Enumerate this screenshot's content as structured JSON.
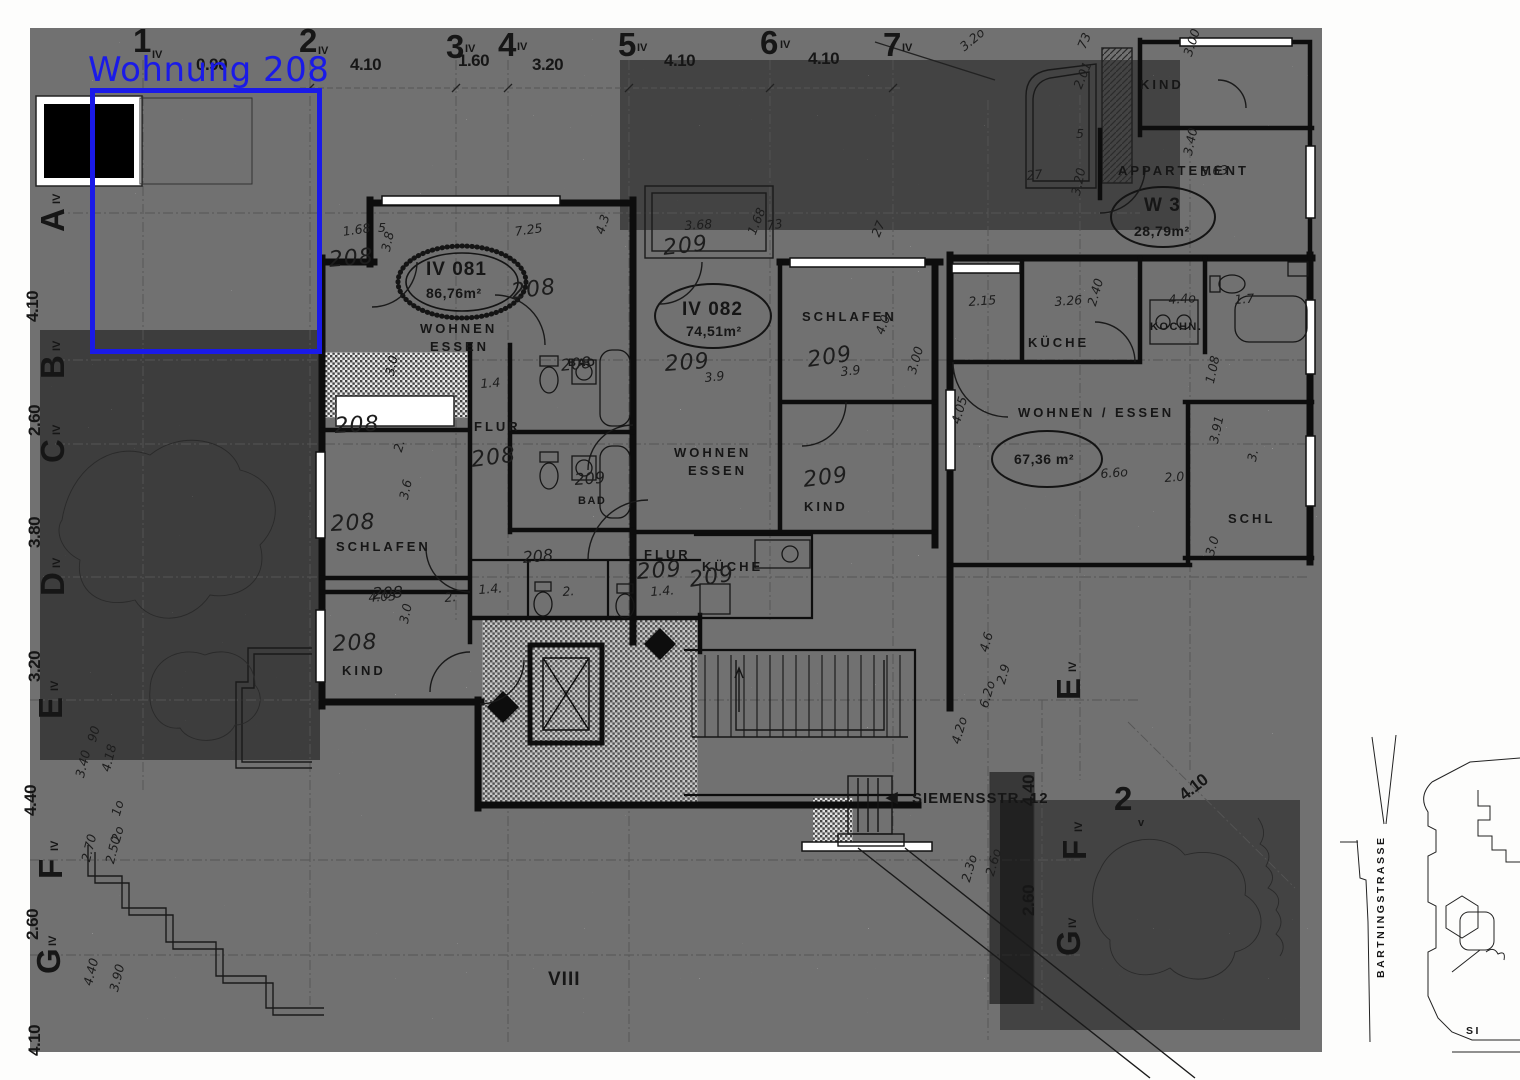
{
  "annotation": {
    "label": "Wohnung 208",
    "color": "#1a1ae8"
  },
  "labels": [
    {
      "t": "1",
      "x": 133,
      "y": 24,
      "c": "gnum",
      "n": "grid-col-1"
    },
    {
      "t": "IV",
      "x": 152,
      "y": 50,
      "c": "gsub"
    },
    {
      "t": "2",
      "x": 299,
      "y": 24,
      "c": "gnum",
      "n": "grid-col-2"
    },
    {
      "t": "IV",
      "x": 318,
      "y": 46,
      "c": "gsub"
    },
    {
      "t": "3",
      "x": 446,
      "y": 30,
      "c": "gnum",
      "n": "grid-col-3"
    },
    {
      "t": "IV",
      "x": 465,
      "y": 44,
      "c": "gsub"
    },
    {
      "t": "4",
      "x": 498,
      "y": 28,
      "c": "gnum",
      "n": "grid-col-4"
    },
    {
      "t": "IV",
      "x": 517,
      "y": 42,
      "c": "gsub"
    },
    {
      "t": "5",
      "x": 618,
      "y": 28,
      "c": "gnum",
      "n": "grid-col-5"
    },
    {
      "t": "IV",
      "x": 637,
      "y": 43,
      "c": "gsub"
    },
    {
      "t": "6",
      "x": 760,
      "y": 26,
      "c": "gnum",
      "n": "grid-col-6"
    },
    {
      "t": "IV",
      "x": 780,
      "y": 40,
      "c": "gsub"
    },
    {
      "t": "7",
      "x": 883,
      "y": 28,
      "c": "gnum",
      "n": "grid-col-7"
    },
    {
      "t": "IV",
      "x": 902,
      "y": 43,
      "c": "gsub"
    },
    {
      "t": "A",
      "x": 36,
      "y": 232,
      "c": "gnum",
      "r": -90,
      "n": "grid-row-a"
    },
    {
      "t": "IV",
      "x": 52,
      "y": 204,
      "c": "gsub",
      "r": -90
    },
    {
      "t": "B",
      "x": 36,
      "y": 379,
      "c": "gnum",
      "r": -90,
      "n": "grid-row-b"
    },
    {
      "t": "IV",
      "x": 52,
      "y": 351,
      "c": "gsub",
      "r": -90
    },
    {
      "t": "C",
      "x": 36,
      "y": 463,
      "c": "gnum",
      "r": -90,
      "n": "grid-row-c"
    },
    {
      "t": "IV",
      "x": 52,
      "y": 435,
      "c": "gsub",
      "r": -90
    },
    {
      "t": "D",
      "x": 36,
      "y": 596,
      "c": "gnum",
      "r": -90,
      "n": "grid-row-d"
    },
    {
      "t": "IV",
      "x": 52,
      "y": 568,
      "c": "gsub",
      "r": -90
    },
    {
      "t": "E",
      "x": 34,
      "y": 719,
      "c": "gnum",
      "r": -90,
      "n": "grid-row-e"
    },
    {
      "t": "IV",
      "x": 50,
      "y": 691,
      "c": "gsub",
      "r": -90
    },
    {
      "t": "F",
      "x": 34,
      "y": 879,
      "c": "gnum",
      "r": -90,
      "n": "grid-row-f"
    },
    {
      "t": "IV",
      "x": 50,
      "y": 851,
      "c": "gsub",
      "r": -90
    },
    {
      "t": "G",
      "x": 32,
      "y": 974,
      "c": "gnum",
      "r": -90,
      "n": "grid-row-g"
    },
    {
      "t": "IV",
      "x": 48,
      "y": 946,
      "c": "gsub",
      "r": -90
    },
    {
      "t": "E",
      "x": 1052,
      "y": 700,
      "c": "gnum",
      "r": -90,
      "n": "grid-row-e-right"
    },
    {
      "t": "IV",
      "x": 1068,
      "y": 672,
      "c": "gsub",
      "r": -90
    },
    {
      "t": "F",
      "x": 1058,
      "y": 860,
      "c": "gnum",
      "r": -90,
      "n": "grid-row-f-right"
    },
    {
      "t": "IV",
      "x": 1074,
      "y": 832,
      "c": "gsub",
      "r": -90
    },
    {
      "t": "G",
      "x": 1052,
      "y": 956,
      "c": "gnum",
      "r": -90,
      "n": "grid-row-g-right"
    },
    {
      "t": "IV",
      "x": 1068,
      "y": 928,
      "c": "gsub",
      "r": -90
    },
    {
      "t": "2",
      "x": 1114,
      "y": 782,
      "c": "gnum",
      "n": "grid-col-2v"
    },
    {
      "t": "v",
      "x": 1138,
      "y": 818,
      "c": "gsub"
    },
    {
      "t": "0.90",
      "x": 196,
      "y": 56,
      "c": "dim"
    },
    {
      "t": "4.10",
      "x": 350,
      "y": 56,
      "c": "dim"
    },
    {
      "t": "1.60",
      "x": 458,
      "y": 52,
      "c": "dim"
    },
    {
      "t": "3.20",
      "x": 532,
      "y": 56,
      "c": "dim"
    },
    {
      "t": "4.10",
      "x": 664,
      "y": 52,
      "c": "dim"
    },
    {
      "t": "4.10",
      "x": 808,
      "y": 50,
      "c": "dim"
    },
    {
      "t": "4.10",
      "x": 24,
      "y": 322,
      "c": "dim",
      "r": -90
    },
    {
      "t": "2.60",
      "x": 26,
      "y": 436,
      "c": "dim",
      "r": -90
    },
    {
      "t": "3.80",
      "x": 26,
      "y": 548,
      "c": "dim",
      "r": -90
    },
    {
      "t": "3.20",
      "x": 26,
      "y": 682,
      "c": "dim",
      "r": -90
    },
    {
      "t": "4.40",
      "x": 22,
      "y": 816,
      "c": "dim",
      "r": -90
    },
    {
      "t": "2.60",
      "x": 24,
      "y": 940,
      "c": "dim",
      "r": -90
    },
    {
      "t": "4.10",
      "x": 26,
      "y": 1056,
      "c": "dim",
      "r": -90
    },
    {
      "t": "4.40",
      "x": 1020,
      "y": 806,
      "c": "dim",
      "r": -90
    },
    {
      "t": "2.60",
      "x": 1020,
      "y": 916,
      "c": "dim",
      "r": -90
    },
    {
      "t": "4.10",
      "x": 1176,
      "y": 790,
      "c": "dim",
      "r": -38
    },
    {
      "t": "KIND",
      "x": 1140,
      "y": 78,
      "c": "room",
      "n": "room-label-kind-top"
    },
    {
      "t": "APPARTEMENT",
      "x": 1118,
      "y": 164,
      "c": "room",
      "n": "room-label-appartement"
    },
    {
      "t": "W 3",
      "x": 1144,
      "y": 196,
      "c": "rmlg",
      "n": "apartment-id-w3"
    },
    {
      "t": "28,79m²",
      "x": 1134,
      "y": 224,
      "c": "area",
      "n": "apartment-area-w3"
    },
    {
      "t": "IV 081",
      "x": 426,
      "y": 260,
      "c": "rmlg",
      "n": "apartment-id-iv081"
    },
    {
      "t": "86,76m²",
      "x": 426,
      "y": 286,
      "c": "area",
      "n": "apartment-area-iv081"
    },
    {
      "t": "WOHNEN",
      "x": 420,
      "y": 322,
      "c": "room",
      "n": "room-label-wohnen-081"
    },
    {
      "t": "ESSEN",
      "x": 430,
      "y": 340,
      "c": "room"
    },
    {
      "t": "IV 082",
      "x": 682,
      "y": 300,
      "c": "rmlg",
      "n": "apartment-id-iv082"
    },
    {
      "t": "74,51m²",
      "x": 686,
      "y": 324,
      "c": "area",
      "n": "apartment-area-iv082"
    },
    {
      "t": "SCHLAFEN",
      "x": 802,
      "y": 310,
      "c": "room",
      "n": "room-label-schlafen-082"
    },
    {
      "t": "KÜCHE",
      "x": 1028,
      "y": 336,
      "c": "room",
      "n": "room-label-kueche-right"
    },
    {
      "t": "KOCHN.",
      "x": 1150,
      "y": 322,
      "c": "roomsm",
      "n": "room-label-kochnische"
    },
    {
      "t": "WOHNEN / ESSEN",
      "x": 1018,
      "y": 406,
      "c": "room",
      "n": "room-label-wohnen-essen-right"
    },
    {
      "t": "67,36 m²",
      "x": 1014,
      "y": 452,
      "c": "area",
      "n": "apartment-area-right"
    },
    {
      "t": "BAD",
      "x": 568,
      "y": 358,
      "c": "roomsm",
      "n": "room-label-bad-upper"
    },
    {
      "t": "FLUR",
      "x": 474,
      "y": 420,
      "c": "room",
      "n": "room-label-flur-081"
    },
    {
      "t": "BAD",
      "x": 578,
      "y": 496,
      "c": "roomsm",
      "n": "room-label-bad-lower"
    },
    {
      "t": "WOHNEN",
      "x": 674,
      "y": 446,
      "c": "room",
      "n": "room-label-wohnen-082"
    },
    {
      "t": "ESSEN",
      "x": 688,
      "y": 464,
      "c": "room"
    },
    {
      "t": "KIND",
      "x": 804,
      "y": 500,
      "c": "room",
      "n": "room-label-kind-082"
    },
    {
      "t": "SCHLAFEN",
      "x": 336,
      "y": 540,
      "c": "room",
      "n": "room-label-schlafen-081"
    },
    {
      "t": "KIND",
      "x": 342,
      "y": 664,
      "c": "room",
      "n": "room-label-kind-081"
    },
    {
      "t": "FLUR",
      "x": 644,
      "y": 548,
      "c": "room",
      "n": "room-label-flur-082"
    },
    {
      "t": "KÜCHE",
      "x": 702,
      "y": 560,
      "c": "room",
      "n": "room-label-kueche-082"
    },
    {
      "t": "SCHL",
      "x": 1228,
      "y": 512,
      "c": "room",
      "n": "room-label-schl-cut"
    },
    {
      "t": "VIII",
      "x": 548,
      "y": 970,
      "c": "rmlg",
      "n": "floor-roman-numeral"
    },
    {
      "t": "◀",
      "x": 886,
      "y": 790,
      "c": "street",
      "n": "direction-arrow-icon"
    },
    {
      "t": "SIEMENSSTR. 12",
      "x": 912,
      "y": 791,
      "c": "street",
      "n": "street-label-siemensstrasse"
    },
    {
      "t": "BARTNINGSTRASSE",
      "x": 1376,
      "y": 978,
      "c": "streetsm",
      "r": -90,
      "n": "street-label-bartningstrasse"
    },
    {
      "t": "SI",
      "x": 1466,
      "y": 1026,
      "c": "streetsm",
      "n": "street-label-si"
    },
    {
      "t": "208",
      "x": 328,
      "y": 250,
      "c": "handlg",
      "r": -5
    },
    {
      "t": "208",
      "x": 510,
      "y": 282,
      "c": "handlg",
      "r": -7
    },
    {
      "t": "208",
      "x": 334,
      "y": 416,
      "c": "handlg",
      "r": -3
    },
    {
      "t": "208",
      "x": 470,
      "y": 450,
      "c": "handlg",
      "r": -7
    },
    {
      "t": "208",
      "x": 330,
      "y": 514,
      "c": "handlg",
      "r": -3
    },
    {
      "t": "208",
      "x": 332,
      "y": 634,
      "c": "handlg",
      "r": -3
    },
    {
      "t": "208",
      "x": 560,
      "y": 358,
      "c": "handmd",
      "r": -6
    },
    {
      "t": "208",
      "x": 522,
      "y": 550,
      "c": "handmd",
      "r": -5
    },
    {
      "t": "208",
      "x": 372,
      "y": 586,
      "c": "handmd",
      "r": -3
    },
    {
      "t": "209",
      "x": 662,
      "y": 238,
      "c": "handlg",
      "r": -6
    },
    {
      "t": "209",
      "x": 664,
      "y": 354,
      "c": "handlg",
      "r": -4
    },
    {
      "t": "209",
      "x": 806,
      "y": 350,
      "c": "handlg",
      "r": -8
    },
    {
      "t": "209",
      "x": 574,
      "y": 472,
      "c": "handmd",
      "r": -4
    },
    {
      "t": "209",
      "x": 802,
      "y": 470,
      "c": "handlg",
      "r": -7
    },
    {
      "t": "209",
      "x": 636,
      "y": 562,
      "c": "handlg",
      "r": -4
    },
    {
      "t": "209",
      "x": 688,
      "y": 570,
      "c": "handlg",
      "r": -8
    },
    {
      "t": "3.9",
      "x": 704,
      "y": 372,
      "c": "hand",
      "r": -6
    },
    {
      "t": "3.9",
      "x": 840,
      "y": 366,
      "c": "hand",
      "r": -6
    },
    {
      "t": "1.68",
      "x": 342,
      "y": 226,
      "c": "hand",
      "r": -8
    },
    {
      "t": "5",
      "x": 378,
      "y": 222,
      "c": "hand"
    },
    {
      "t": "7.25",
      "x": 514,
      "y": 226,
      "c": "hand",
      "r": -8
    },
    {
      "t": "4.3",
      "x": 594,
      "y": 232,
      "c": "hand",
      "r": -72
    },
    {
      "t": "3.8",
      "x": 380,
      "y": 250,
      "c": "hand",
      "r": -78
    },
    {
      "t": "3.0",
      "x": 384,
      "y": 374,
      "c": "hand",
      "r": -78
    },
    {
      "t": "3.68",
      "x": 684,
      "y": 220,
      "c": "hand",
      "r": -4
    },
    {
      "t": "1.68",
      "x": 746,
      "y": 232,
      "c": "hand",
      "r": -68
    },
    {
      "t": "73",
      "x": 766,
      "y": 220,
      "c": "hand",
      "r": -8
    },
    {
      "t": "27",
      "x": 870,
      "y": 234,
      "c": "hand",
      "r": -68
    },
    {
      "t": "3.2o",
      "x": 958,
      "y": 44,
      "c": "hand",
      "r": -40
    },
    {
      "t": "73",
      "x": 1076,
      "y": 46,
      "c": "hand",
      "r": -68
    },
    {
      "t": "3.00",
      "x": 1182,
      "y": 54,
      "c": "hand",
      "r": -72
    },
    {
      "t": "2.01",
      "x": 1072,
      "y": 86,
      "c": "hand",
      "r": -68
    },
    {
      "t": "5",
      "x": 1076,
      "y": 128,
      "c": "hand"
    },
    {
      "t": "3.20",
      "x": 1070,
      "y": 194,
      "c": "hand",
      "r": -78
    },
    {
      "t": "27",
      "x": 1026,
      "y": 170,
      "c": "hand",
      "r": -6
    },
    {
      "t": "3.40",
      "x": 1182,
      "y": 154,
      "c": "hand",
      "r": -78
    },
    {
      "t": "5.63",
      "x": 1200,
      "y": 166,
      "c": "hand",
      "r": -4
    },
    {
      "t": "2.15",
      "x": 968,
      "y": 296,
      "c": "hand",
      "r": -4
    },
    {
      "t": "3.26",
      "x": 1054,
      "y": 296,
      "c": "hand",
      "r": -4
    },
    {
      "t": "2.40",
      "x": 1086,
      "y": 304,
      "c": "hand",
      "r": -74
    },
    {
      "t": "4.4o",
      "x": 1168,
      "y": 294,
      "c": "hand",
      "r": -4
    },
    {
      "t": "1.7",
      "x": 1234,
      "y": 294,
      "c": "hand",
      "r": -4
    },
    {
      "t": "4.05",
      "x": 950,
      "y": 422,
      "c": "hand",
      "r": -74
    },
    {
      "t": "6.6o",
      "x": 1100,
      "y": 468,
      "c": "hand",
      "r": -4
    },
    {
      "t": "2.0",
      "x": 1164,
      "y": 472,
      "c": "hand",
      "r": -4
    },
    {
      "t": "1.08",
      "x": 1204,
      "y": 382,
      "c": "hand",
      "r": -78
    },
    {
      "t": "3.91",
      "x": 1208,
      "y": 442,
      "c": "hand",
      "r": -78
    },
    {
      "t": "3.",
      "x": 1246,
      "y": 460,
      "c": "hand",
      "r": -78
    },
    {
      "t": "3.0",
      "x": 1204,
      "y": 554,
      "c": "hand",
      "r": -74
    },
    {
      "t": "4.0",
      "x": 874,
      "y": 332,
      "c": "hand",
      "r": -70
    },
    {
      "t": "3.00",
      "x": 906,
      "y": 372,
      "c": "hand",
      "r": -74
    },
    {
      "t": "1.4",
      "x": 480,
      "y": 378,
      "c": "hand",
      "r": -4
    },
    {
      "t": "1.4.",
      "x": 478,
      "y": 584,
      "c": "hand",
      "r": -4
    },
    {
      "t": "2.",
      "x": 562,
      "y": 586,
      "c": "hand",
      "r": -4
    },
    {
      "t": "1.4.",
      "x": 650,
      "y": 586,
      "c": "hand",
      "r": -4
    },
    {
      "t": "4.03",
      "x": 368,
      "y": 592,
      "c": "hand",
      "r": -4
    },
    {
      "t": "2.",
      "x": 444,
      "y": 592,
      "c": "hand",
      "r": -4
    },
    {
      "t": "3.6",
      "x": 398,
      "y": 498,
      "c": "hand",
      "r": -78
    },
    {
      "t": "3.0",
      "x": 398,
      "y": 622,
      "c": "hand",
      "r": -78
    },
    {
      "t": "2.",
      "x": 392,
      "y": 450,
      "c": "hand",
      "r": -74
    },
    {
      "t": "90",
      "x": 86,
      "y": 740,
      "c": "hand",
      "r": -74
    },
    {
      "t": "3.40",
      "x": 74,
      "y": 776,
      "c": "hand",
      "r": -76
    },
    {
      "t": "4.18",
      "x": 100,
      "y": 770,
      "c": "hand",
      "r": -76
    },
    {
      "t": "1o",
      "x": 110,
      "y": 814,
      "c": "hand",
      "r": -74
    },
    {
      "t": "2o",
      "x": 110,
      "y": 840,
      "c": "hand",
      "r": -74
    },
    {
      "t": "2.70",
      "x": 80,
      "y": 860,
      "c": "hand",
      "r": -76
    },
    {
      "t": "2.50",
      "x": 104,
      "y": 862,
      "c": "hand",
      "r": -76
    },
    {
      "t": "4.40",
      "x": 82,
      "y": 984,
      "c": "hand",
      "r": -76
    },
    {
      "t": "3.90",
      "x": 108,
      "y": 990,
      "c": "hand",
      "r": -76
    },
    {
      "t": "4.2o",
      "x": 950,
      "y": 742,
      "c": "hand",
      "r": -74
    },
    {
      "t": "2.6o",
      "x": 984,
      "y": 874,
      "c": "hand",
      "r": -74
    },
    {
      "t": "2.3o",
      "x": 960,
      "y": 880,
      "c": "hand",
      "r": -74
    },
    {
      "t": "4.6",
      "x": 978,
      "y": 650,
      "c": "hand",
      "r": -74
    },
    {
      "t": "6.2o",
      "x": 978,
      "y": 706,
      "c": "hand",
      "r": -74
    },
    {
      "t": "2.9",
      "x": 995,
      "y": 682,
      "c": "hand",
      "r": -74
    }
  ]
}
